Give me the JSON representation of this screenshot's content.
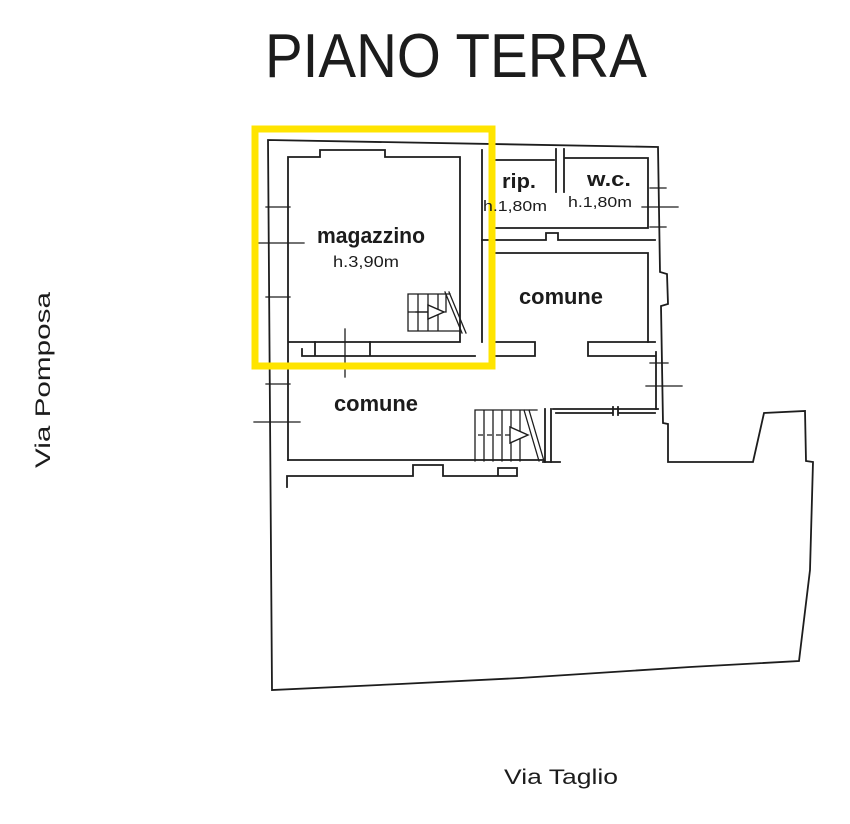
{
  "title": "PIANO TERRA",
  "streets": {
    "left": "Via Pomposa",
    "bottom": "Via Taglio"
  },
  "rooms": {
    "magazzino": {
      "label": "magazzino",
      "height": "h.3,90m"
    },
    "rip": {
      "label": "rip.",
      "height": "h.1,80m"
    },
    "wc": {
      "label": "w.c.",
      "height": "h.1,80m"
    },
    "comune_upper": {
      "label": "comune"
    },
    "comune_lower": {
      "label": "comune"
    }
  },
  "highlight": {
    "color": "#ffe400"
  },
  "colors": {
    "line": "#1d1d1d",
    "muted": "#8a8a8a",
    "background": "#ffffff"
  }
}
